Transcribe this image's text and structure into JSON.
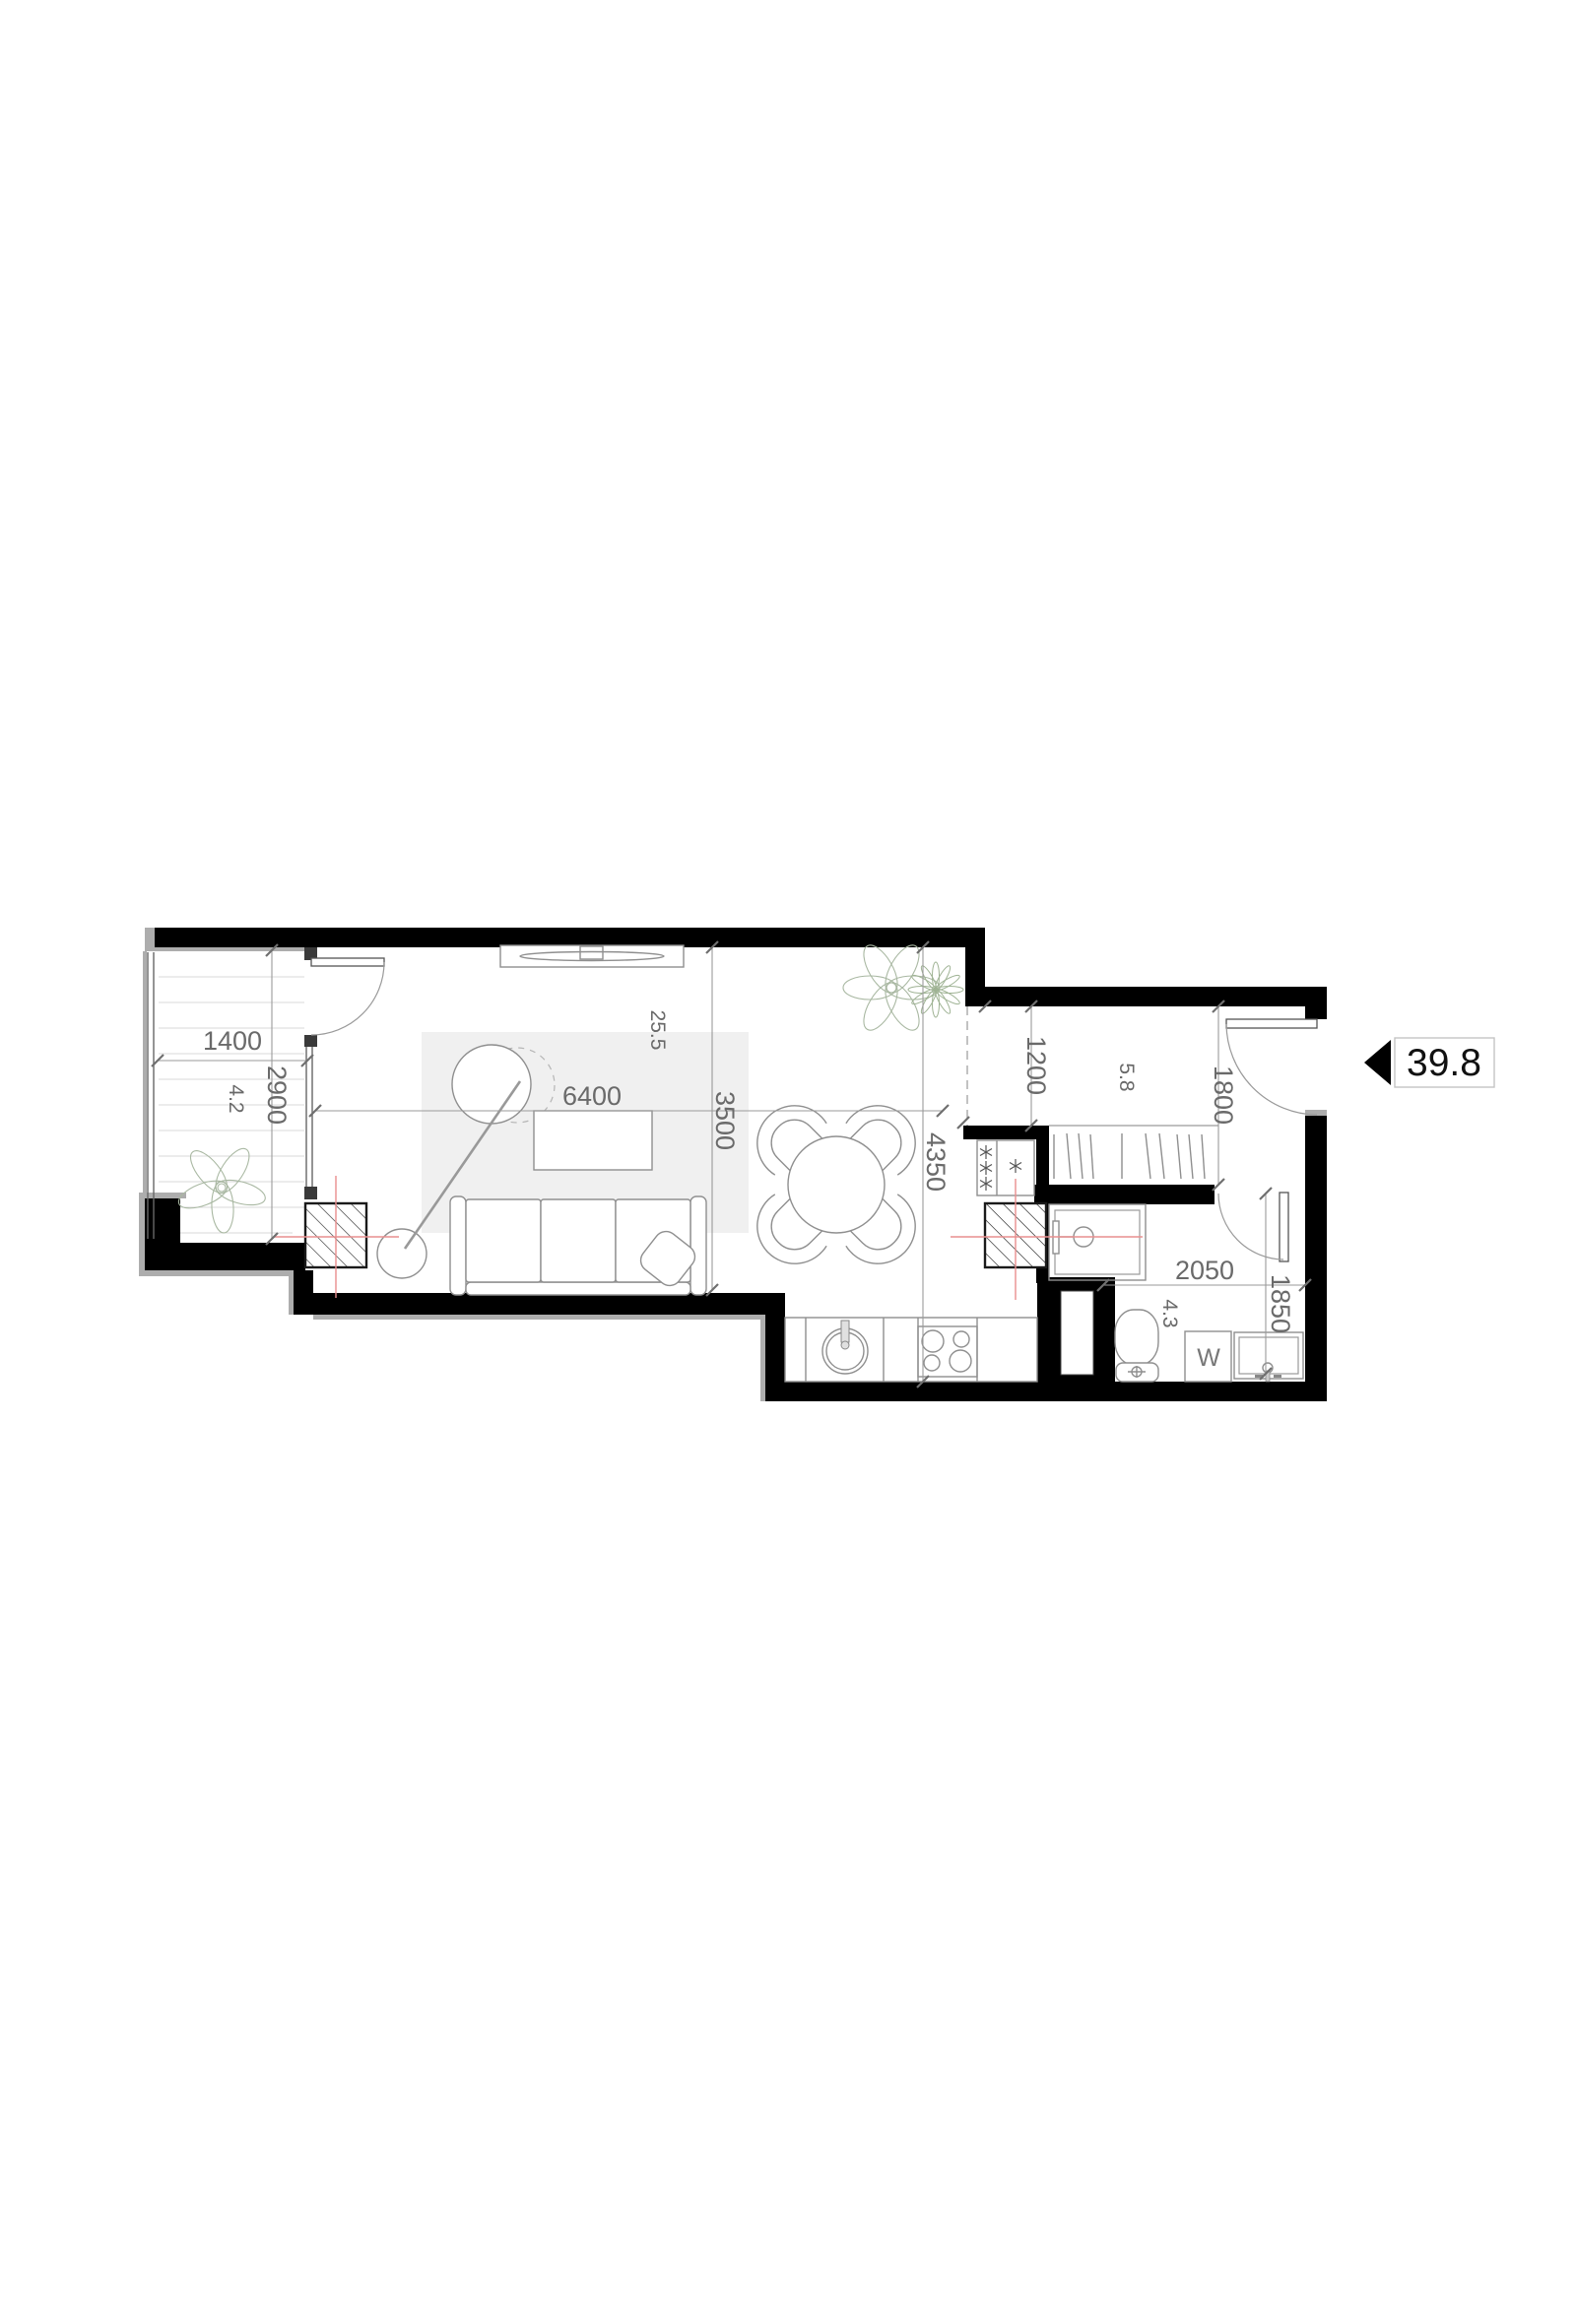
{
  "floorplan": {
    "unit": {
      "total_area": "39.8"
    },
    "rooms": [
      {
        "name": "balcony",
        "area": "4.2"
      },
      {
        "name": "living-room-kitchen",
        "area": "25.5"
      },
      {
        "name": "hallway",
        "area": "5.8"
      },
      {
        "name": "bathroom",
        "area": "4.3"
      }
    ],
    "dims": {
      "balcony_width": "1400",
      "balcony_depth": "2900",
      "living_width": "6400",
      "living_depth": "3500",
      "kitchen_wall": "4350",
      "hall_upper": "1200",
      "hall_entry": "1800",
      "bath_width": "2050",
      "bath_depth": "1850"
    },
    "fixtures": {
      "washing_machine": "W"
    },
    "colors": {
      "wall": "#000000",
      "dimension_text": "#6a6a6a",
      "centerline_red": "#e98f8f",
      "rug_fill": "#f0f0f0",
      "plant_stroke": "#a9b8a2",
      "badge_text": "#111111"
    }
  }
}
